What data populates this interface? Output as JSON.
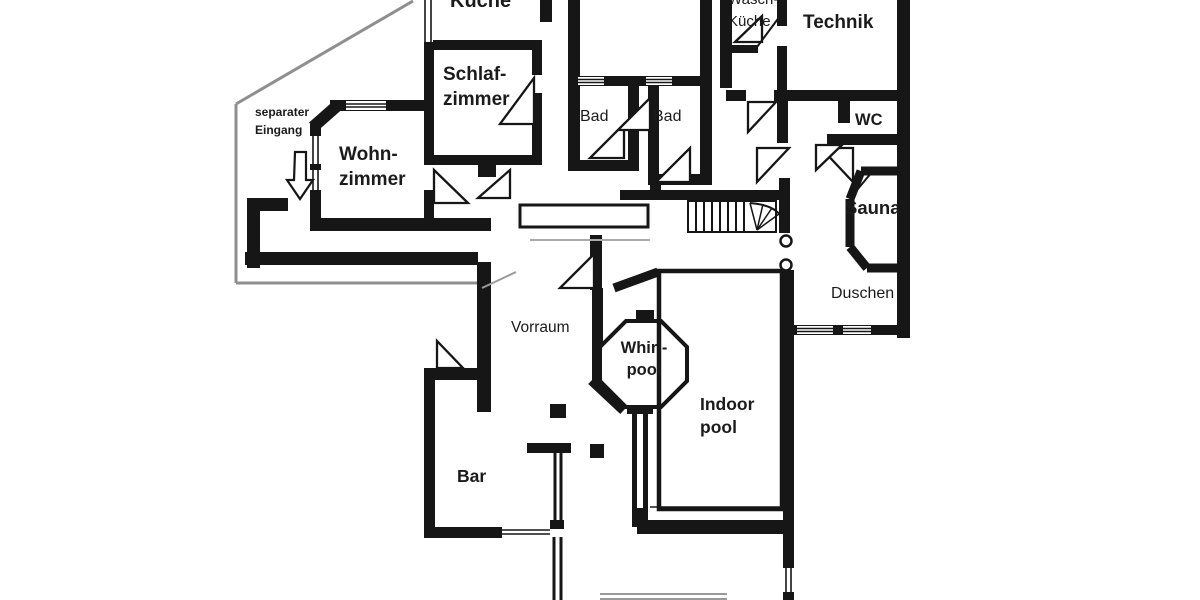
{
  "document": {
    "type": "scanned architectural floor plan",
    "language": "German"
  },
  "colors": {
    "paper": "#ffffff",
    "wall": "#161616",
    "outline_gray": "#8f8f8f",
    "faint_line": "#9a9a9a"
  },
  "rooms": {
    "kueche": "Küche",
    "schlafzimmer": "Schlaf-\nzimmer",
    "wasch_kueche": "Wasch-\nKüche",
    "technik": "Technik",
    "bad_1": "Bad",
    "bad_2": "Bad",
    "wc": "WC",
    "wohnzimmer": "Wohn-\nzimmer",
    "sauna": "Sauna",
    "duschen": "Duschen",
    "vorraum": "Vorraum",
    "whirlpool": "Whirl-\npool",
    "indoor_pool": "Indoor\npool",
    "bar": "Bar"
  },
  "annotations": {
    "separate_entrance": "separater\nEingang"
  },
  "icons": {
    "entrance_arrow": "down-arrow"
  }
}
